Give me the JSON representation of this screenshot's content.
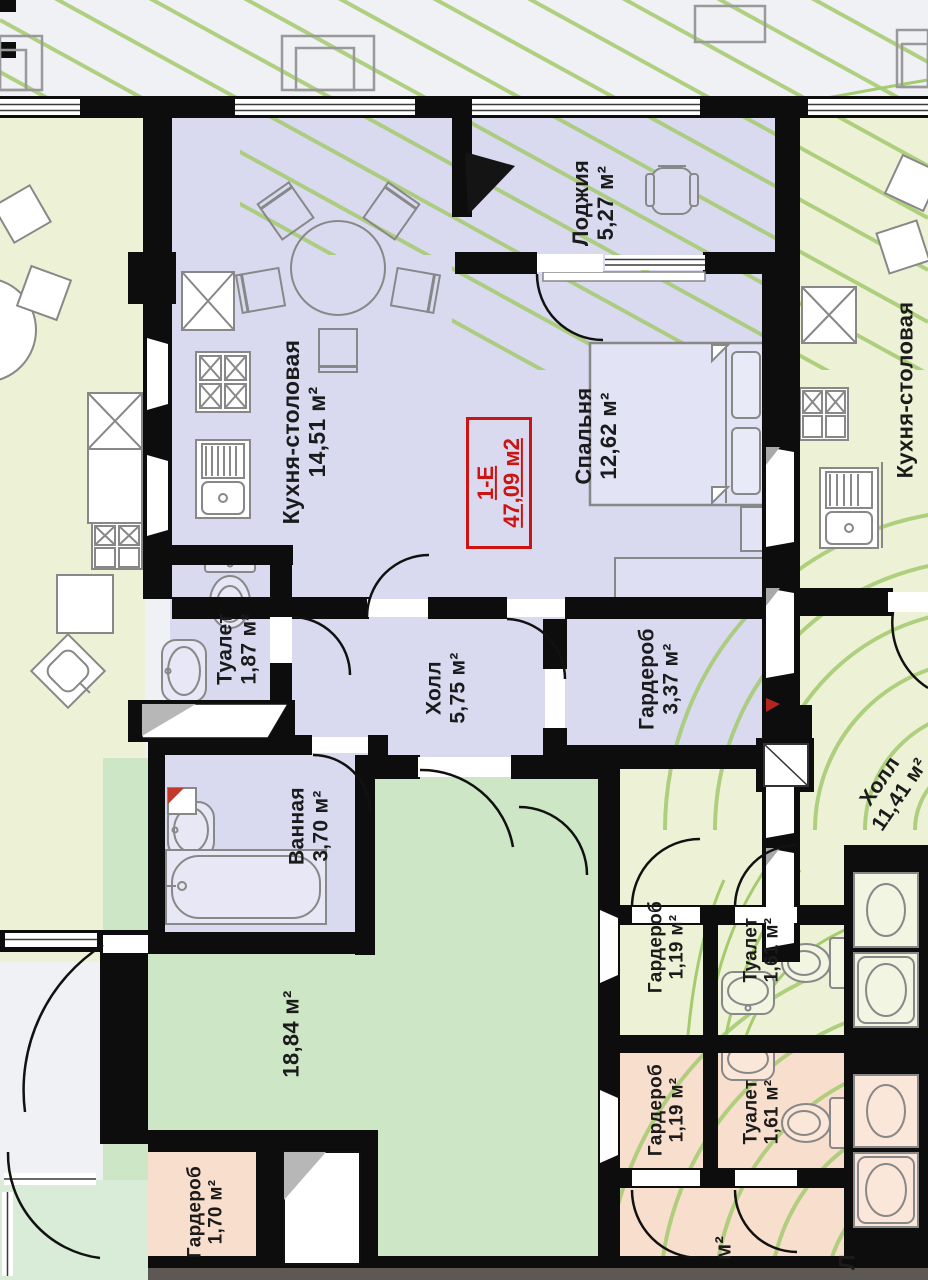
{
  "unit": {
    "code": "1-Е",
    "area": "47,09 м2"
  },
  "rooms": {
    "kitchen": {
      "name": "Кухня-столовая",
      "area": "14,51 м²"
    },
    "loggia": {
      "name": "Лоджия",
      "area": "5,27 м²"
    },
    "bedroom": {
      "name": "Спальня",
      "area": "12,62 м²"
    },
    "toilet": {
      "name": "Туалет",
      "area": "1,87 м²"
    },
    "hall": {
      "name": "Холл",
      "area": "5,75 м²"
    },
    "wardrobe": {
      "name": "Гардероб",
      "area": "3,37 м²"
    },
    "bathroom": {
      "name": "Ванная",
      "area": "3,70 м²"
    },
    "common_area": {
      "area": "18,84 м²"
    },
    "hall_right": {
      "name": "Холл",
      "area": "11,41 м²"
    },
    "kitchen_right": {
      "name": "Кухня-столовая"
    },
    "wardrobe_upper_right": {
      "name": "Гардероб",
      "area": "1,19 м²"
    },
    "toilet_upper_right": {
      "name": "Туалет",
      "area": "1,61 м²"
    },
    "wardrobe_lower_right": {
      "name": "Гардероб",
      "area": "1,19 м²"
    },
    "toilet_lower_right": {
      "name": "Туалет",
      "area": "1,61 м²"
    },
    "wardrobe_bottom_left": {
      "name": "Гардероб",
      "area": "1,70 м²"
    },
    "edge_partial": {
      "name": "Л",
      "area": "м²"
    }
  },
  "colors": {
    "unit_fill": "#d9daf0",
    "neighbor_fill": "#edf2d6",
    "common_fill": "#cde6c6",
    "lower_fill": "#f8decd",
    "wall": "#0d0d0d",
    "accent_red": "#cc1512",
    "landscape_green": "#a7cc74"
  }
}
